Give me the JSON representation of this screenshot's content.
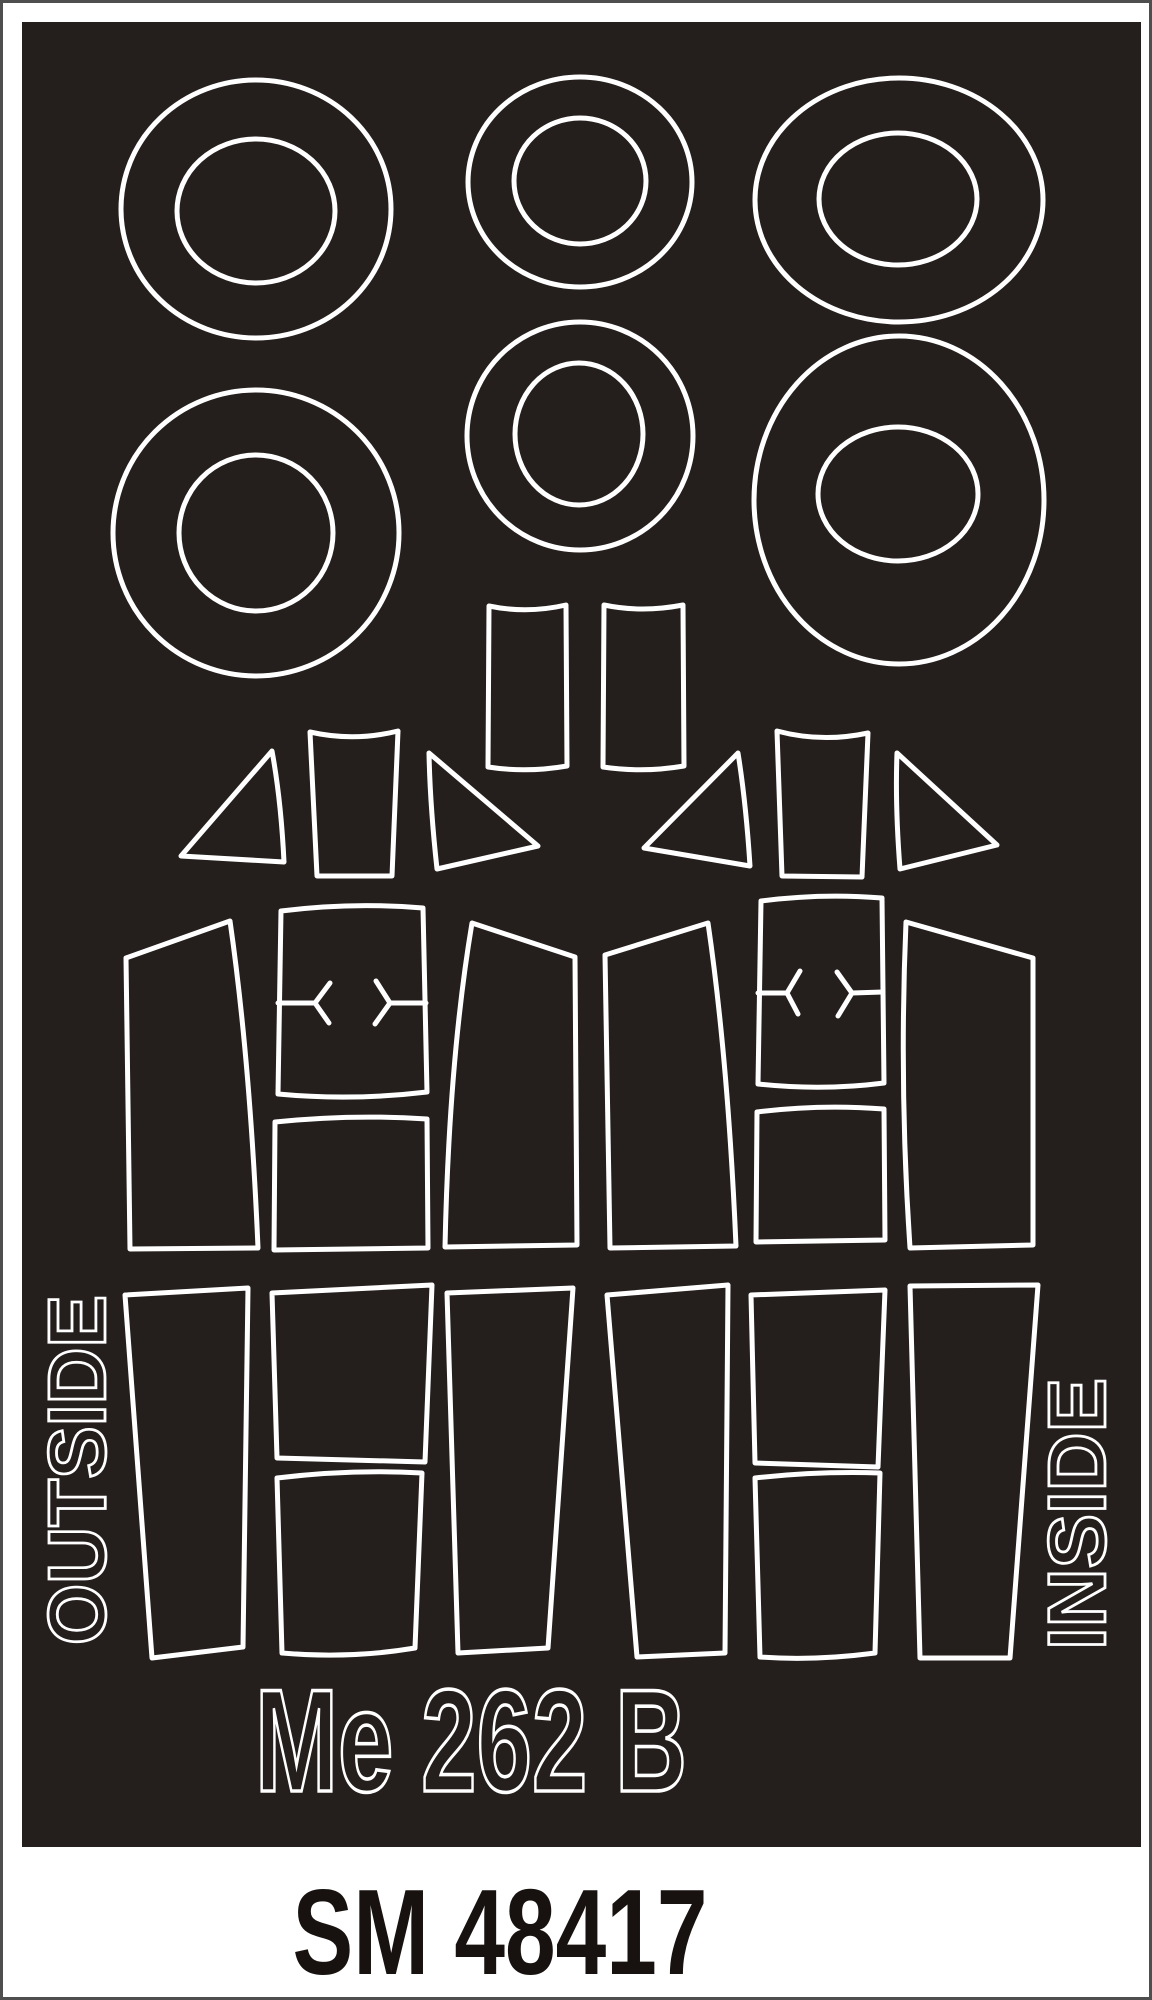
{
  "product": {
    "subject_title": "Me 262 B",
    "product_code": "SM 48417"
  },
  "labels": {
    "left_vertical": "OUTSIDE",
    "right_vertical": "INSIDE"
  },
  "colors": {
    "sheet_black": "#241e1c",
    "cut_line_white": "#ffffff",
    "page_white": "#ffffff",
    "frame_gray": "#4e4e4e",
    "code_text_black": "#17120f"
  },
  "sheet": {
    "x": 22,
    "y": 22,
    "width": 1119,
    "height": 1825
  },
  "shapes": [
    {
      "name": "wheel-mask-outer-1",
      "kind": "ellipse",
      "cx": 256,
      "cy": 209,
      "rx": 135,
      "ry": 129
    },
    {
      "name": "wheel-mask-inner-1",
      "kind": "ellipse",
      "cx": 256,
      "cy": 211,
      "rx": 79,
      "ry": 72
    },
    {
      "name": "wheel-mask-outer-2",
      "kind": "ellipse",
      "cx": 580,
      "cy": 182,
      "rx": 112,
      "ry": 105
    },
    {
      "name": "wheel-mask-inner-2",
      "kind": "ellipse",
      "cx": 580,
      "cy": 181,
      "rx": 66,
      "ry": 63
    },
    {
      "name": "wheel-mask-outer-3",
      "kind": "ellipse",
      "cx": 899,
      "cy": 200,
      "rx": 144,
      "ry": 122
    },
    {
      "name": "wheel-mask-inner-3",
      "kind": "ellipse",
      "cx": 898,
      "cy": 199,
      "rx": 79,
      "ry": 66
    },
    {
      "name": "wheel-mask-outer-4",
      "kind": "ellipse",
      "cx": 256,
      "cy": 533,
      "rx": 143,
      "ry": 143
    },
    {
      "name": "wheel-mask-inner-4",
      "kind": "ellipse",
      "cx": 256,
      "cy": 533,
      "rx": 77,
      "ry": 78
    },
    {
      "name": "wheel-mask-outer-5",
      "kind": "ellipse",
      "cx": 580,
      "cy": 436,
      "rx": 113,
      "ry": 114
    },
    {
      "name": "wheel-mask-inner-5",
      "kind": "ellipse",
      "cx": 579,
      "cy": 434,
      "rx": 64,
      "ry": 71
    },
    {
      "name": "wheel-mask-outer-6",
      "kind": "ellipse",
      "cx": 899,
      "cy": 500,
      "rx": 145,
      "ry": 164
    },
    {
      "name": "wheel-mask-inner-6",
      "kind": "ellipse",
      "cx": 898,
      "cy": 494,
      "rx": 80,
      "ry": 67
    },
    {
      "name": "canopy-rect-mask-left",
      "kind": "path",
      "d": "M489,606 Q527,614 566,605 L567,766 Q527,773 488,767 Z"
    },
    {
      "name": "canopy-rect-mask-right",
      "kind": "path",
      "d": "M604,605 Q642,613 683,605 L684,766 Q643,773 603,767 Z"
    },
    {
      "name": "canopy-triangle-mask-l1",
      "kind": "path",
      "d": "M272,751 L181,856 L284,862 Q281,800 272,751 Z"
    },
    {
      "name": "canopy-trapezoid-mask-l",
      "kind": "path",
      "d": "M310,732 Q354,742 398,731 L392,876 L317,876 Z"
    },
    {
      "name": "canopy-triangle-mask-l2",
      "kind": "path",
      "d": "M429,753 L538,846 L437,869 Q430,805 429,753 Z"
    },
    {
      "name": "canopy-triangle-mask-r1",
      "kind": "path",
      "d": "M738,753 L644,848 L750,866 Q746,803 738,753 Z"
    },
    {
      "name": "canopy-trapezoid-mask-r",
      "kind": "path",
      "d": "M777,731 Q822,743 868,733 L862,877 L782,876 Z"
    },
    {
      "name": "canopy-triangle-mask-r2",
      "kind": "path",
      "d": "M897,753 L997,845 L900,869 Q895,805 897,753 Z"
    },
    {
      "name": "canopy-side-mask-l-left",
      "kind": "path",
      "d": "M126,958 L230,921 Q250,1060 258,1248 L130,1249 Z"
    },
    {
      "name": "canopy-top-mask-l",
      "kind": "path",
      "d": "M281,911 Q352,902 423,908 L427,1092 Q352,1101 278,1094 Z"
    },
    {
      "name": "alignment-mark-l-left",
      "kind": "path",
      "d": "M278,1003 L315,1003 M330,983 L315,1003 L329,1023"
    },
    {
      "name": "alignment-mark-l-right",
      "kind": "path",
      "d": "M426,1003 L390,1003 M376,981 L390,1003 L375,1024"
    },
    {
      "name": "canopy-square-mask-l",
      "kind": "path",
      "d": "M275,1122 Q352,1114 427,1119 L428,1248 L274,1250 Z"
    },
    {
      "name": "canopy-side-mask-l-right",
      "kind": "path",
      "d": "M472,923 L575,957 L577,1245 L445,1247 Q449,1060 472,923 Z"
    },
    {
      "name": "canopy-side-mask-r-left",
      "kind": "path",
      "d": "M605,955 L708,923 Q728,1060 736,1246 L610,1248 Z"
    },
    {
      "name": "canopy-top-mask-r",
      "kind": "path",
      "d": "M761,901 Q822,893 882,898 L884,1083 Q822,1091 758,1084 Z"
    },
    {
      "name": "alignment-mark-r-left",
      "kind": "path",
      "d": "M758,993 L787,993 M800,971 L787,993 L798,1014"
    },
    {
      "name": "alignment-mark-r-right",
      "kind": "path",
      "d": "M883,992 L852,993 M837,972 L852,993 L838,1016"
    },
    {
      "name": "canopy-square-mask-r",
      "kind": "path",
      "d": "M757,1112 Q820,1104 884,1109 L885,1240 L756,1242 Z"
    },
    {
      "name": "canopy-side-mask-r-right",
      "kind": "path",
      "d": "M906,922 L1033,958 L1033,1245 L910,1248 Q899,1085 906,922 Z"
    },
    {
      "name": "canopy-bottom-mask-1",
      "kind": "path",
      "d": "M125,1295 L248,1288 L243,1647 L152,1658 Z"
    },
    {
      "name": "canopy-bottom-mask-2a",
      "kind": "path",
      "d": "M272,1293 L432,1285 L425,1462 L277,1458 Z"
    },
    {
      "name": "canopy-bottom-mask-2b",
      "kind": "path",
      "d": "M277,1478 Q352,1469 422,1473 L415,1648 Q350,1659 282,1653 Z"
    },
    {
      "name": "canopy-bottom-mask-3",
      "kind": "path",
      "d": "M447,1293 L573,1288 L548,1648 L458,1653 Z"
    },
    {
      "name": "canopy-bottom-mask-4",
      "kind": "path",
      "d": "M607,1295 L728,1285 L725,1653 L637,1657 Z"
    },
    {
      "name": "canopy-bottom-mask-5a",
      "kind": "path",
      "d": "M751,1295 L885,1290 L878,1467 L755,1463 Z"
    },
    {
      "name": "canopy-bottom-mask-5b",
      "kind": "path",
      "d": "M755,1478 Q818,1471 880,1473 L875,1653 Q815,1661 760,1657 Z"
    },
    {
      "name": "canopy-bottom-mask-6",
      "kind": "path",
      "d": "M910,1286 L1038,1285 L1010,1658 L920,1658 Z"
    }
  ]
}
